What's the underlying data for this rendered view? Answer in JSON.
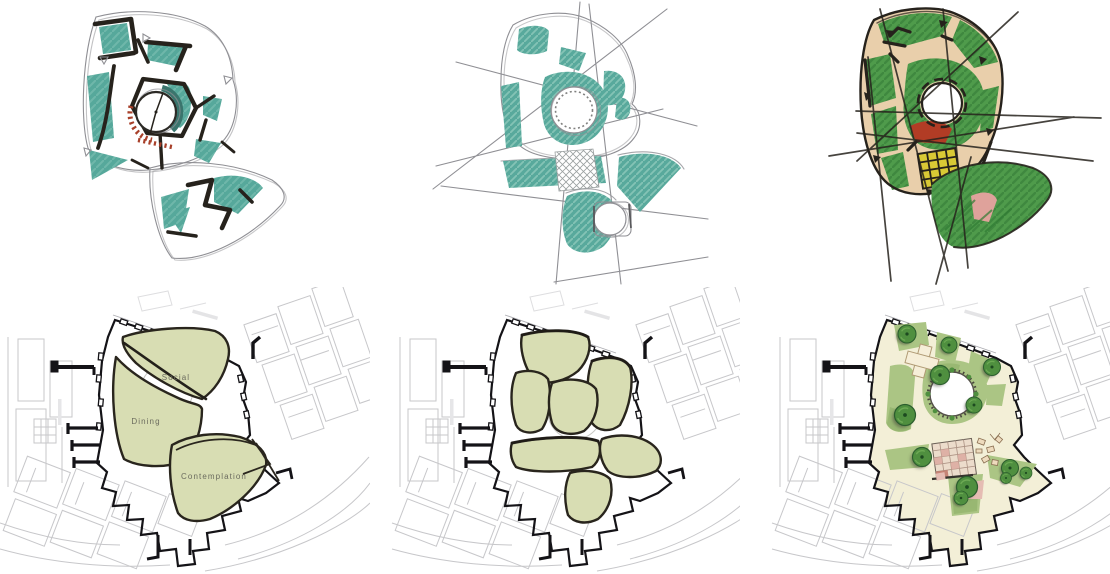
{
  "plans": {
    "labeled_zones": {
      "social": "Social",
      "dining": "Dining",
      "contemplation": "Contemplation"
    }
  },
  "colors": {
    "teal": "#56a89b",
    "teal_light": "#79beb1",
    "teal_dark": "#3a756d",
    "ink": "#26221c",
    "pencil": "#8f8f94",
    "marker_green": "#4f9b4b",
    "marker_green_dark": "#37803a",
    "tan": "#e9cfab",
    "yellow": "#d9c935",
    "rust": "#a8402a",
    "red": "#b23c25",
    "pink": "#dfa29b",
    "zone_fill": "#d8ddb3",
    "zone_stroke": "#29251d",
    "cream": "#f3efd7",
    "lawn": "#abc584",
    "lawn_dark": "#8fb169",
    "tree": "#4f8f3f",
    "tree_dark": "#2c5e2e",
    "site_gray": "#c7c7ca",
    "boundary": "#141317",
    "paving_pink": "#dcaaa0"
  }
}
